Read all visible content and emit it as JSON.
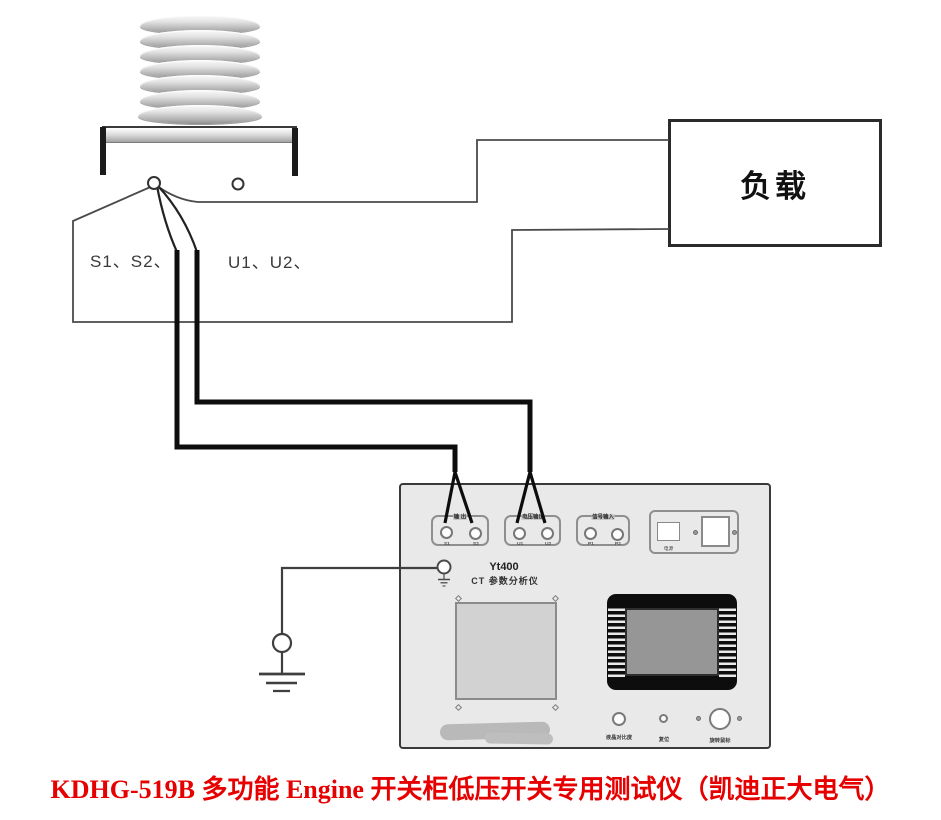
{
  "colors": {
    "caption_red": "#e60000",
    "wire_black": "#0d0d0d",
    "wire_thin": "#4a4a4a",
    "panel_gray": "#e9e9e9"
  },
  "ct": {
    "secondary_label": "S1、S2、",
    "primary_label": "U1、U2、"
  },
  "load": {
    "label": "负载"
  },
  "instrument": {
    "model": "Yt400",
    "subtitle": "CT 参数分析仪",
    "groups": [
      {
        "label": "输 出",
        "t1": "S1",
        "t2": "S2"
      },
      {
        "label": "电压输出",
        "t1": "U1",
        "t2": "U2"
      },
      {
        "label": "信号输入",
        "t1": "P1",
        "t2": "P2"
      }
    ],
    "power_label": "电源",
    "controls": {
      "contrast": "液晶对比度",
      "reset": "复位",
      "mouse": "旋转鼠标"
    }
  },
  "caption": "KDHG-519B 多功能 Engine 开关柜低压开关专用测试仪（凯迪正大电气）"
}
